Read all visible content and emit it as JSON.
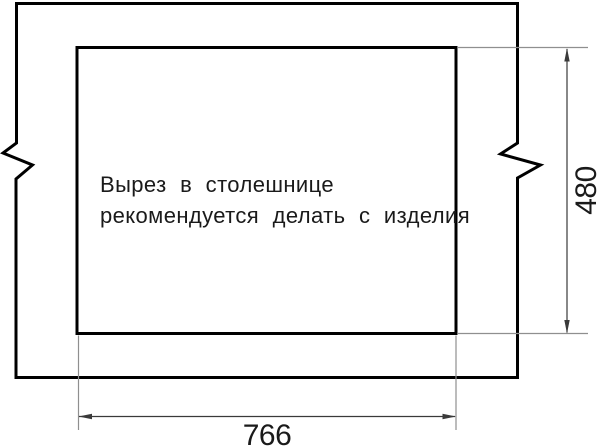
{
  "drawing": {
    "note": {
      "line1": "Вырез в столешнице",
      "line2": "рекомендуется делать с изделия"
    },
    "dimensions": {
      "width_label": "766",
      "height_label": "480"
    },
    "colors": {
      "outline": "#000000",
      "dimension_line": "#3a3a3a",
      "extension_line": "#8f8f8f",
      "text": "#1a1a1a",
      "background": "#ffffff"
    }
  }
}
